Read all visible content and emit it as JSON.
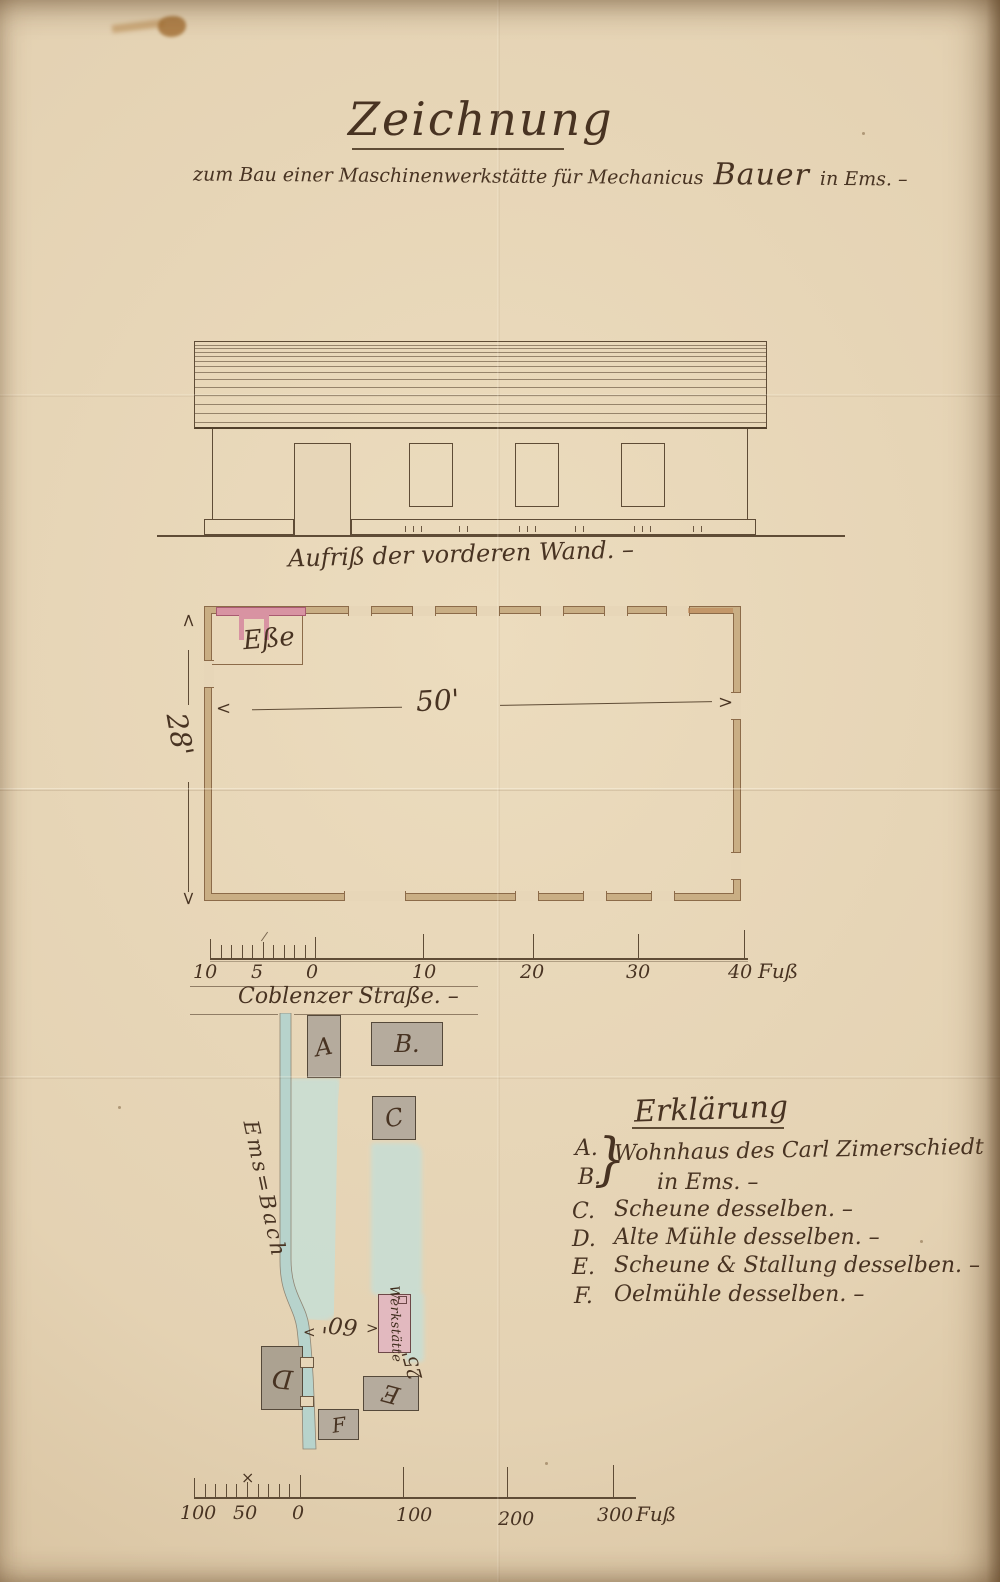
{
  "document": {
    "title": "Zeichnung",
    "subtitle_pre": "zum Bau einer Maschinenwerkstätte für Mechanicus",
    "subtitle_name": "Bauer",
    "subtitle_post": "in Ems. –"
  },
  "elevation": {
    "caption": "Aufriß der vorderen Wand. –"
  },
  "floor_plan": {
    "width_label": "50'",
    "height_label": "28'",
    "forge_label": "Eße"
  },
  "scale_small": {
    "labels": [
      "10",
      "5",
      "0",
      "10",
      "20",
      "30",
      "40"
    ],
    "unit": "Fuß"
  },
  "site_plan": {
    "street_label": "Coblenzer Straße. –",
    "stream_label": "Ems=Bach",
    "dim_width": "60'",
    "dim_depth": "25'",
    "workshop_label": "Werkstätte",
    "buildings": {
      "a": "A",
      "b": "B.",
      "c": "C",
      "d": "D",
      "e": "E",
      "f": "F"
    }
  },
  "legend": {
    "title": "Erklärung",
    "brace": "}",
    "items": [
      {
        "key": "A.",
        "key2": "B.",
        "text": "Wohnhaus des Carl Zimerschiedt",
        "text2": "in Ems. –"
      },
      {
        "key": "C.",
        "text": "Scheune desselben. –"
      },
      {
        "key": "D.",
        "text": "Alte Mühle desselben. –"
      },
      {
        "key": "E.",
        "text": "Scheune & Stallung desselben. –"
      },
      {
        "key": "F.",
        "text": "Oelmühle desselben. –"
      }
    ]
  },
  "scale_large": {
    "labels": [
      "100",
      "50",
      "0",
      "100",
      "200",
      "300"
    ],
    "unit": "Fuß"
  },
  "colors": {
    "paper": "#e6d5b6",
    "ink": "#483322",
    "plan_wall": "#c9ae84",
    "chimney_pink": "#d893a2",
    "workshop_pink": "#e2b9bf",
    "water_blue": "#bfd9d1",
    "building_gray": "#b5ab9d"
  }
}
